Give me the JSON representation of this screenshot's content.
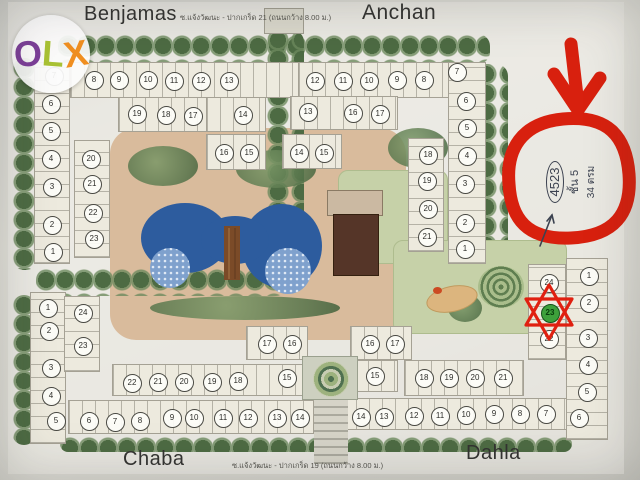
{
  "watermark": {
    "letters": [
      {
        "ch": "O",
        "color": "#7c3f98",
        "rot": -3
      },
      {
        "ch": "L",
        "color": "#a9c234",
        "rot": 4
      },
      {
        "ch": "X",
        "color": "#f08f21",
        "rot": -9
      }
    ]
  },
  "street_labels": {
    "top": "Benjamas",
    "top_right": "Anchan",
    "bottom": "Chaba",
    "bottom_right": "Dahla",
    "soi_top": "ซ.แจ้งวัฒนะ - ปากเกร็ด 21 (ถนนกว้าง 8.00 ม.)",
    "soi_bottom": "ซ.แจ้งวัฒนะ - ปากเกร็ด 19 (ถนนกว้าง 8.00 ม.)"
  },
  "handwritten_note": {
    "unit": "4523",
    "floor": "ชั้น 5",
    "area": "34 ตรม"
  },
  "highlighted_building": "23",
  "colors": {
    "annotation_red": "#d8200e",
    "pool_blue": "#2d5c9e",
    "highlight_green": "#3da03b",
    "ink": "#3c4250"
  },
  "building_markers": [
    {
      "n": "7",
      "x": 53,
      "y": 75
    },
    {
      "n": "8",
      "x": 93,
      "y": 79
    },
    {
      "n": "9",
      "x": 118,
      "y": 79
    },
    {
      "n": "10",
      "x": 147,
      "y": 79
    },
    {
      "n": "11",
      "x": 173,
      "y": 80
    },
    {
      "n": "12",
      "x": 200,
      "y": 80
    },
    {
      "n": "13",
      "x": 228,
      "y": 80
    },
    {
      "n": "6",
      "x": 50,
      "y": 103
    },
    {
      "n": "5",
      "x": 50,
      "y": 130
    },
    {
      "n": "4",
      "x": 50,
      "y": 158
    },
    {
      "n": "3",
      "x": 51,
      "y": 186
    },
    {
      "n": "2",
      "x": 51,
      "y": 224
    },
    {
      "n": "1",
      "x": 52,
      "y": 251
    },
    {
      "n": "19",
      "x": 136,
      "y": 113
    },
    {
      "n": "18",
      "x": 165,
      "y": 114
    },
    {
      "n": "17",
      "x": 192,
      "y": 115
    },
    {
      "n": "14",
      "x": 242,
      "y": 114
    },
    {
      "n": "16",
      "x": 223,
      "y": 152
    },
    {
      "n": "15",
      "x": 248,
      "y": 152
    },
    {
      "n": "20",
      "x": 90,
      "y": 158
    },
    {
      "n": "21",
      "x": 91,
      "y": 183
    },
    {
      "n": "22",
      "x": 92,
      "y": 212
    },
    {
      "n": "23",
      "x": 93,
      "y": 238
    },
    {
      "n": "12",
      "x": 314,
      "y": 80
    },
    {
      "n": "11",
      "x": 342,
      "y": 80
    },
    {
      "n": "10",
      "x": 368,
      "y": 80
    },
    {
      "n": "9",
      "x": 396,
      "y": 79
    },
    {
      "n": "8",
      "x": 423,
      "y": 79
    },
    {
      "n": "7",
      "x": 456,
      "y": 71
    },
    {
      "n": "13",
      "x": 307,
      "y": 111
    },
    {
      "n": "16",
      "x": 352,
      "y": 112
    },
    {
      "n": "17",
      "x": 379,
      "y": 113
    },
    {
      "n": "14",
      "x": 298,
      "y": 152
    },
    {
      "n": "15",
      "x": 323,
      "y": 152
    },
    {
      "n": "6",
      "x": 465,
      "y": 100
    },
    {
      "n": "5",
      "x": 466,
      "y": 127
    },
    {
      "n": "4",
      "x": 466,
      "y": 155
    },
    {
      "n": "3",
      "x": 464,
      "y": 183
    },
    {
      "n": "2",
      "x": 464,
      "y": 222
    },
    {
      "n": "1",
      "x": 464,
      "y": 248
    },
    {
      "n": "18",
      "x": 427,
      "y": 154
    },
    {
      "n": "19",
      "x": 426,
      "y": 180
    },
    {
      "n": "20",
      "x": 427,
      "y": 208
    },
    {
      "n": "21",
      "x": 426,
      "y": 236
    },
    {
      "n": "1",
      "x": 47,
      "y": 307
    },
    {
      "n": "2",
      "x": 48,
      "y": 330
    },
    {
      "n": "3",
      "x": 50,
      "y": 367
    },
    {
      "n": "4",
      "x": 50,
      "y": 395
    },
    {
      "n": "5",
      "x": 55,
      "y": 420
    },
    {
      "n": "24",
      "x": 82,
      "y": 312
    },
    {
      "n": "23",
      "x": 82,
      "y": 345
    },
    {
      "n": "17",
      "x": 266,
      "y": 343
    },
    {
      "n": "16",
      "x": 291,
      "y": 343
    },
    {
      "n": "22",
      "x": 131,
      "y": 382
    },
    {
      "n": "21",
      "x": 157,
      "y": 381
    },
    {
      "n": "20",
      "x": 183,
      "y": 381
    },
    {
      "n": "19",
      "x": 211,
      "y": 381
    },
    {
      "n": "18",
      "x": 237,
      "y": 380
    },
    {
      "n": "15",
      "x": 286,
      "y": 377
    },
    {
      "n": "6",
      "x": 88,
      "y": 420
    },
    {
      "n": "7",
      "x": 114,
      "y": 421
    },
    {
      "n": "8",
      "x": 139,
      "y": 420
    },
    {
      "n": "9",
      "x": 171,
      "y": 417
    },
    {
      "n": "10",
      "x": 193,
      "y": 417
    },
    {
      "n": "11",
      "x": 222,
      "y": 417
    },
    {
      "n": "12",
      "x": 247,
      "y": 417
    },
    {
      "n": "13",
      "x": 276,
      "y": 417
    },
    {
      "n": "14",
      "x": 299,
      "y": 417
    },
    {
      "n": "16",
      "x": 369,
      "y": 343
    },
    {
      "n": "17",
      "x": 394,
      "y": 343
    },
    {
      "n": "15",
      "x": 374,
      "y": 375
    },
    {
      "n": "18",
      "x": 423,
      "y": 377
    },
    {
      "n": "19",
      "x": 448,
      "y": 377
    },
    {
      "n": "20",
      "x": 474,
      "y": 377
    },
    {
      "n": "21",
      "x": 502,
      "y": 377
    },
    {
      "n": "14",
      "x": 360,
      "y": 416
    },
    {
      "n": "13",
      "x": 383,
      "y": 416
    },
    {
      "n": "12",
      "x": 413,
      "y": 415
    },
    {
      "n": "11",
      "x": 439,
      "y": 415
    },
    {
      "n": "10",
      "x": 465,
      "y": 414
    },
    {
      "n": "9",
      "x": 493,
      "y": 413
    },
    {
      "n": "8",
      "x": 519,
      "y": 413
    },
    {
      "n": "7",
      "x": 545,
      "y": 413
    },
    {
      "n": "24",
      "x": 548,
      "y": 282
    },
    {
      "n": "23",
      "x": 549,
      "y": 312,
      "hl": true
    },
    {
      "n": "22",
      "x": 548,
      "y": 338
    },
    {
      "n": "1",
      "x": 588,
      "y": 275
    },
    {
      "n": "2",
      "x": 588,
      "y": 302
    },
    {
      "n": "3",
      "x": 587,
      "y": 337
    },
    {
      "n": "4",
      "x": 587,
      "y": 364
    },
    {
      "n": "5",
      "x": 586,
      "y": 391
    },
    {
      "n": "6",
      "x": 578,
      "y": 417
    }
  ]
}
